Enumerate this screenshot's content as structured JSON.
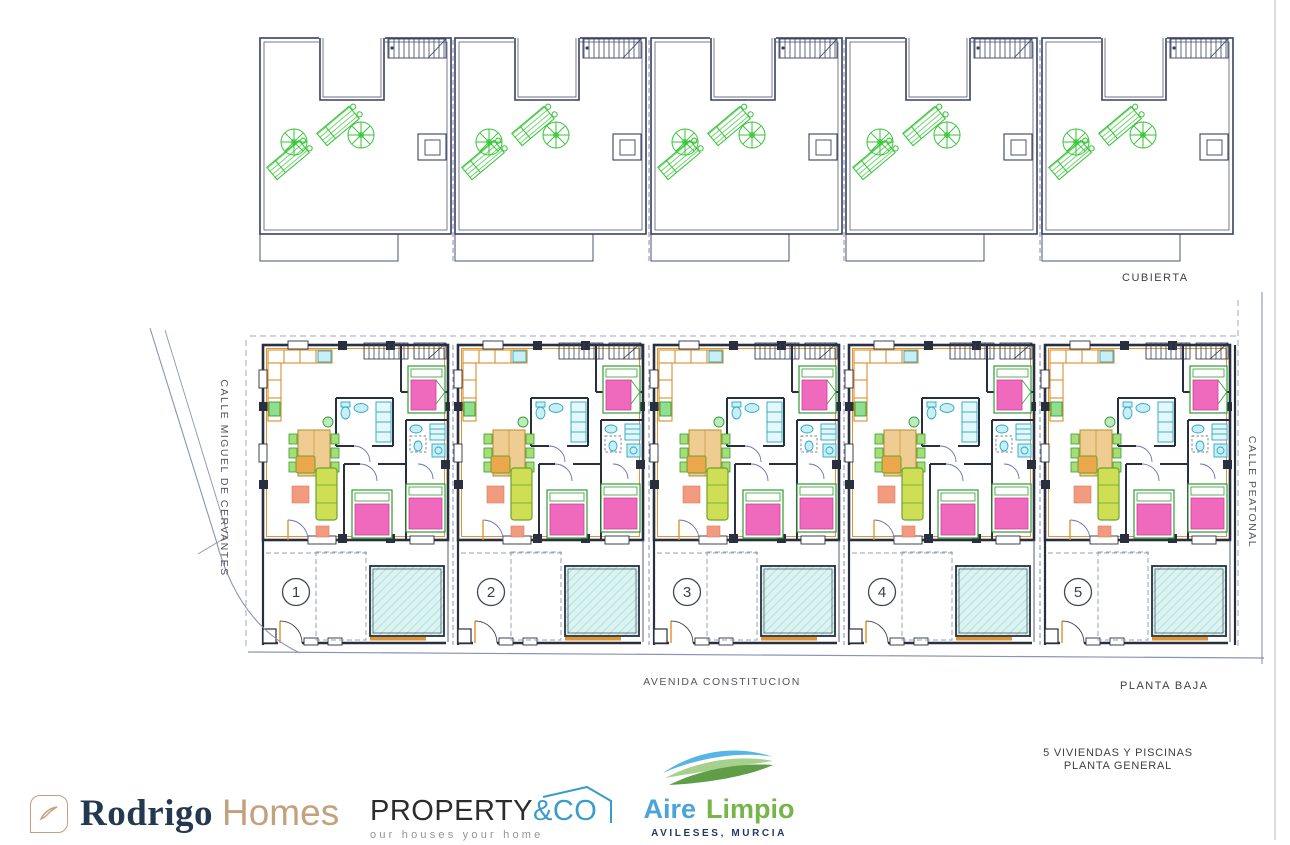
{
  "drawing": {
    "roof_section_label": "CUBIERTA",
    "ground_section_label": "PLANTA BAJA",
    "streets": {
      "left": "CALLE MIGUEL DE CERVANTES",
      "bottom": "AVENIDA CONSTITUCION",
      "right": "CALLE PEATONAL"
    },
    "unit_numbers": [
      "1",
      "2",
      "3",
      "4",
      "5"
    ],
    "title_block": {
      "line1": "5 VIVIENDAS Y PISCINAS",
      "line2": "PLANTA GENERAL"
    }
  },
  "logos": {
    "rodrigo_homes": {
      "name_primary": "Rodrigo",
      "name_secondary": "Homes"
    },
    "property_co": {
      "name_primary": "PROPERTY",
      "name_accent": "&CO",
      "tagline": "our houses your home"
    },
    "aire_limpio": {
      "name_primary": "Aire",
      "name_secondary": "Limpio",
      "location": "AVILESES, MURCIA"
    }
  },
  "colors": {
    "wall": "#28303f",
    "accent_orange": "#e2952f",
    "furniture_green": "#2fae2f",
    "bed_pink": "#ef6abc",
    "fixture_cyan": "#c8eef6",
    "pool_fill": "#ddf3f1",
    "pool_hatch": "#a3e2dc",
    "landscape_green": "#35c435",
    "logo_navy": "#24384f",
    "logo_tan": "#c2a17c",
    "logo_blue": "#3a9cc9",
    "logo_green": "#76b54a"
  }
}
